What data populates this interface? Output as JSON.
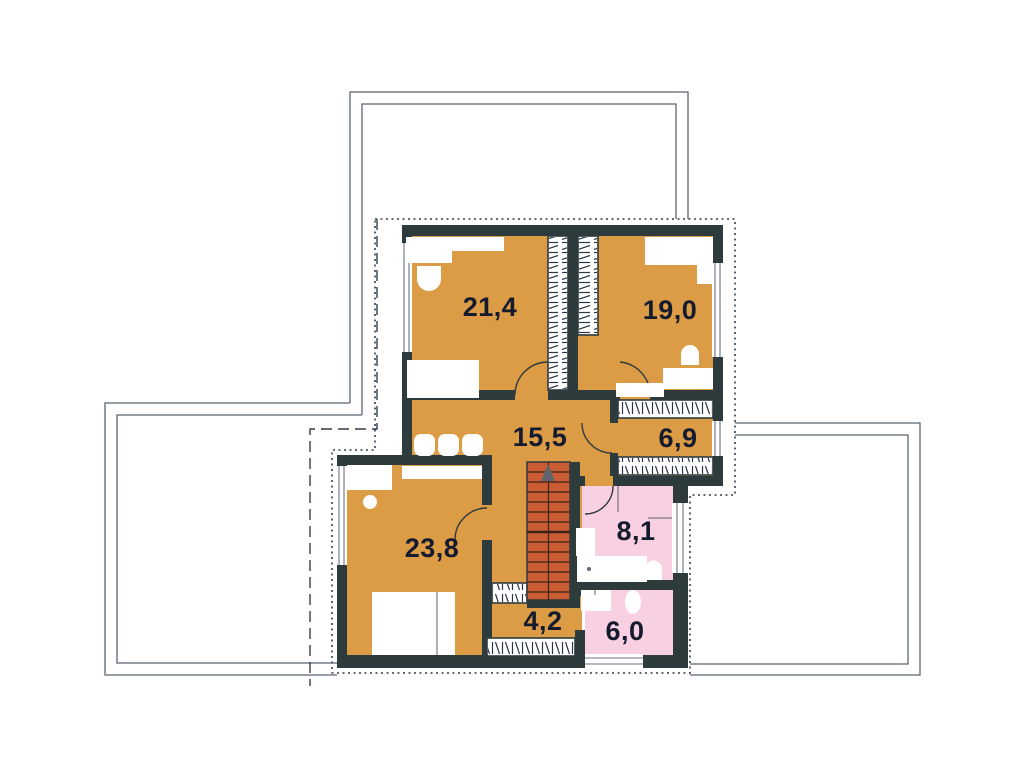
{
  "floorplan": {
    "rooms": [
      {
        "name": "bedroom-top-left",
        "area": "21,4"
      },
      {
        "name": "bedroom-top-right",
        "area": "19,0"
      },
      {
        "name": "hall",
        "area": "15,5"
      },
      {
        "name": "walk-in-closet",
        "area": "6,9"
      },
      {
        "name": "bedroom-bottom-left",
        "area": "23,8"
      },
      {
        "name": "bathroom",
        "area": "8,1"
      },
      {
        "name": "corridor",
        "area": "4,2"
      },
      {
        "name": "wc-laundry",
        "area": "6,0"
      }
    ],
    "colors": {
      "background": "#ffffff",
      "wall": "#2e3b3c",
      "floor": "#dc9b45",
      "wet_floor": "#f9cfe2",
      "stairs": "#c95c33",
      "stair_tread": "#3c2317",
      "roof_line": "#5b6472",
      "outline": "#333d4d",
      "window_frame": "#6a7480",
      "label": "#141b2e"
    }
  }
}
